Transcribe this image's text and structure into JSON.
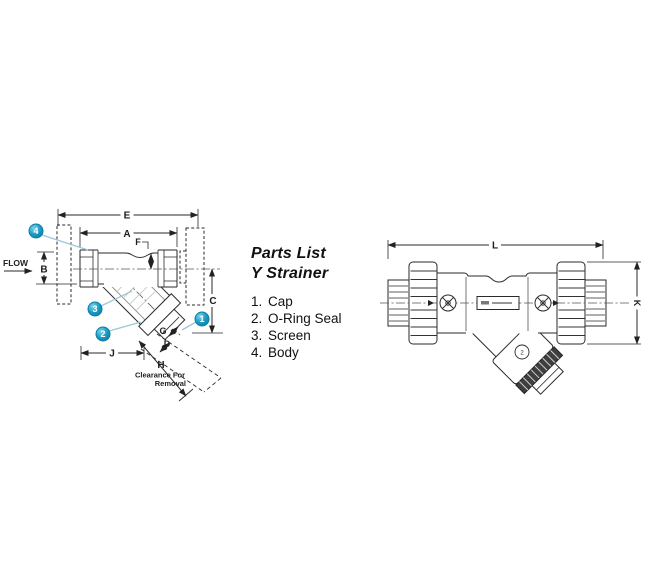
{
  "parts_list": {
    "title1": "Parts List",
    "title2": "Y Strainer",
    "items": [
      {
        "num": "1.",
        "name": "Cap"
      },
      {
        "num": "2.",
        "name": "O-Ring Seal"
      },
      {
        "num": "3.",
        "name": "Screen"
      },
      {
        "num": "4.",
        "name": "Body"
      }
    ]
  },
  "left": {
    "flow": "FLOW",
    "E": "E",
    "A": "A",
    "F": "F",
    "B": "B",
    "C": "C",
    "G": "G",
    "D": "D",
    "J": "J",
    "H": "H",
    "clearance1": "Clearance For",
    "clearance2": "Removal",
    "callout1": "1",
    "callout2": "2",
    "callout3": "3",
    "callout4": "4"
  },
  "right": {
    "L": "L",
    "K": "K",
    "cap_mark": "2"
  },
  "colors": {
    "line": "#2a2a2a",
    "callout_blue": "#1391ba",
    "leader_blue": "#9ec7d6",
    "knurl_dark": "#3f3f3f"
  }
}
